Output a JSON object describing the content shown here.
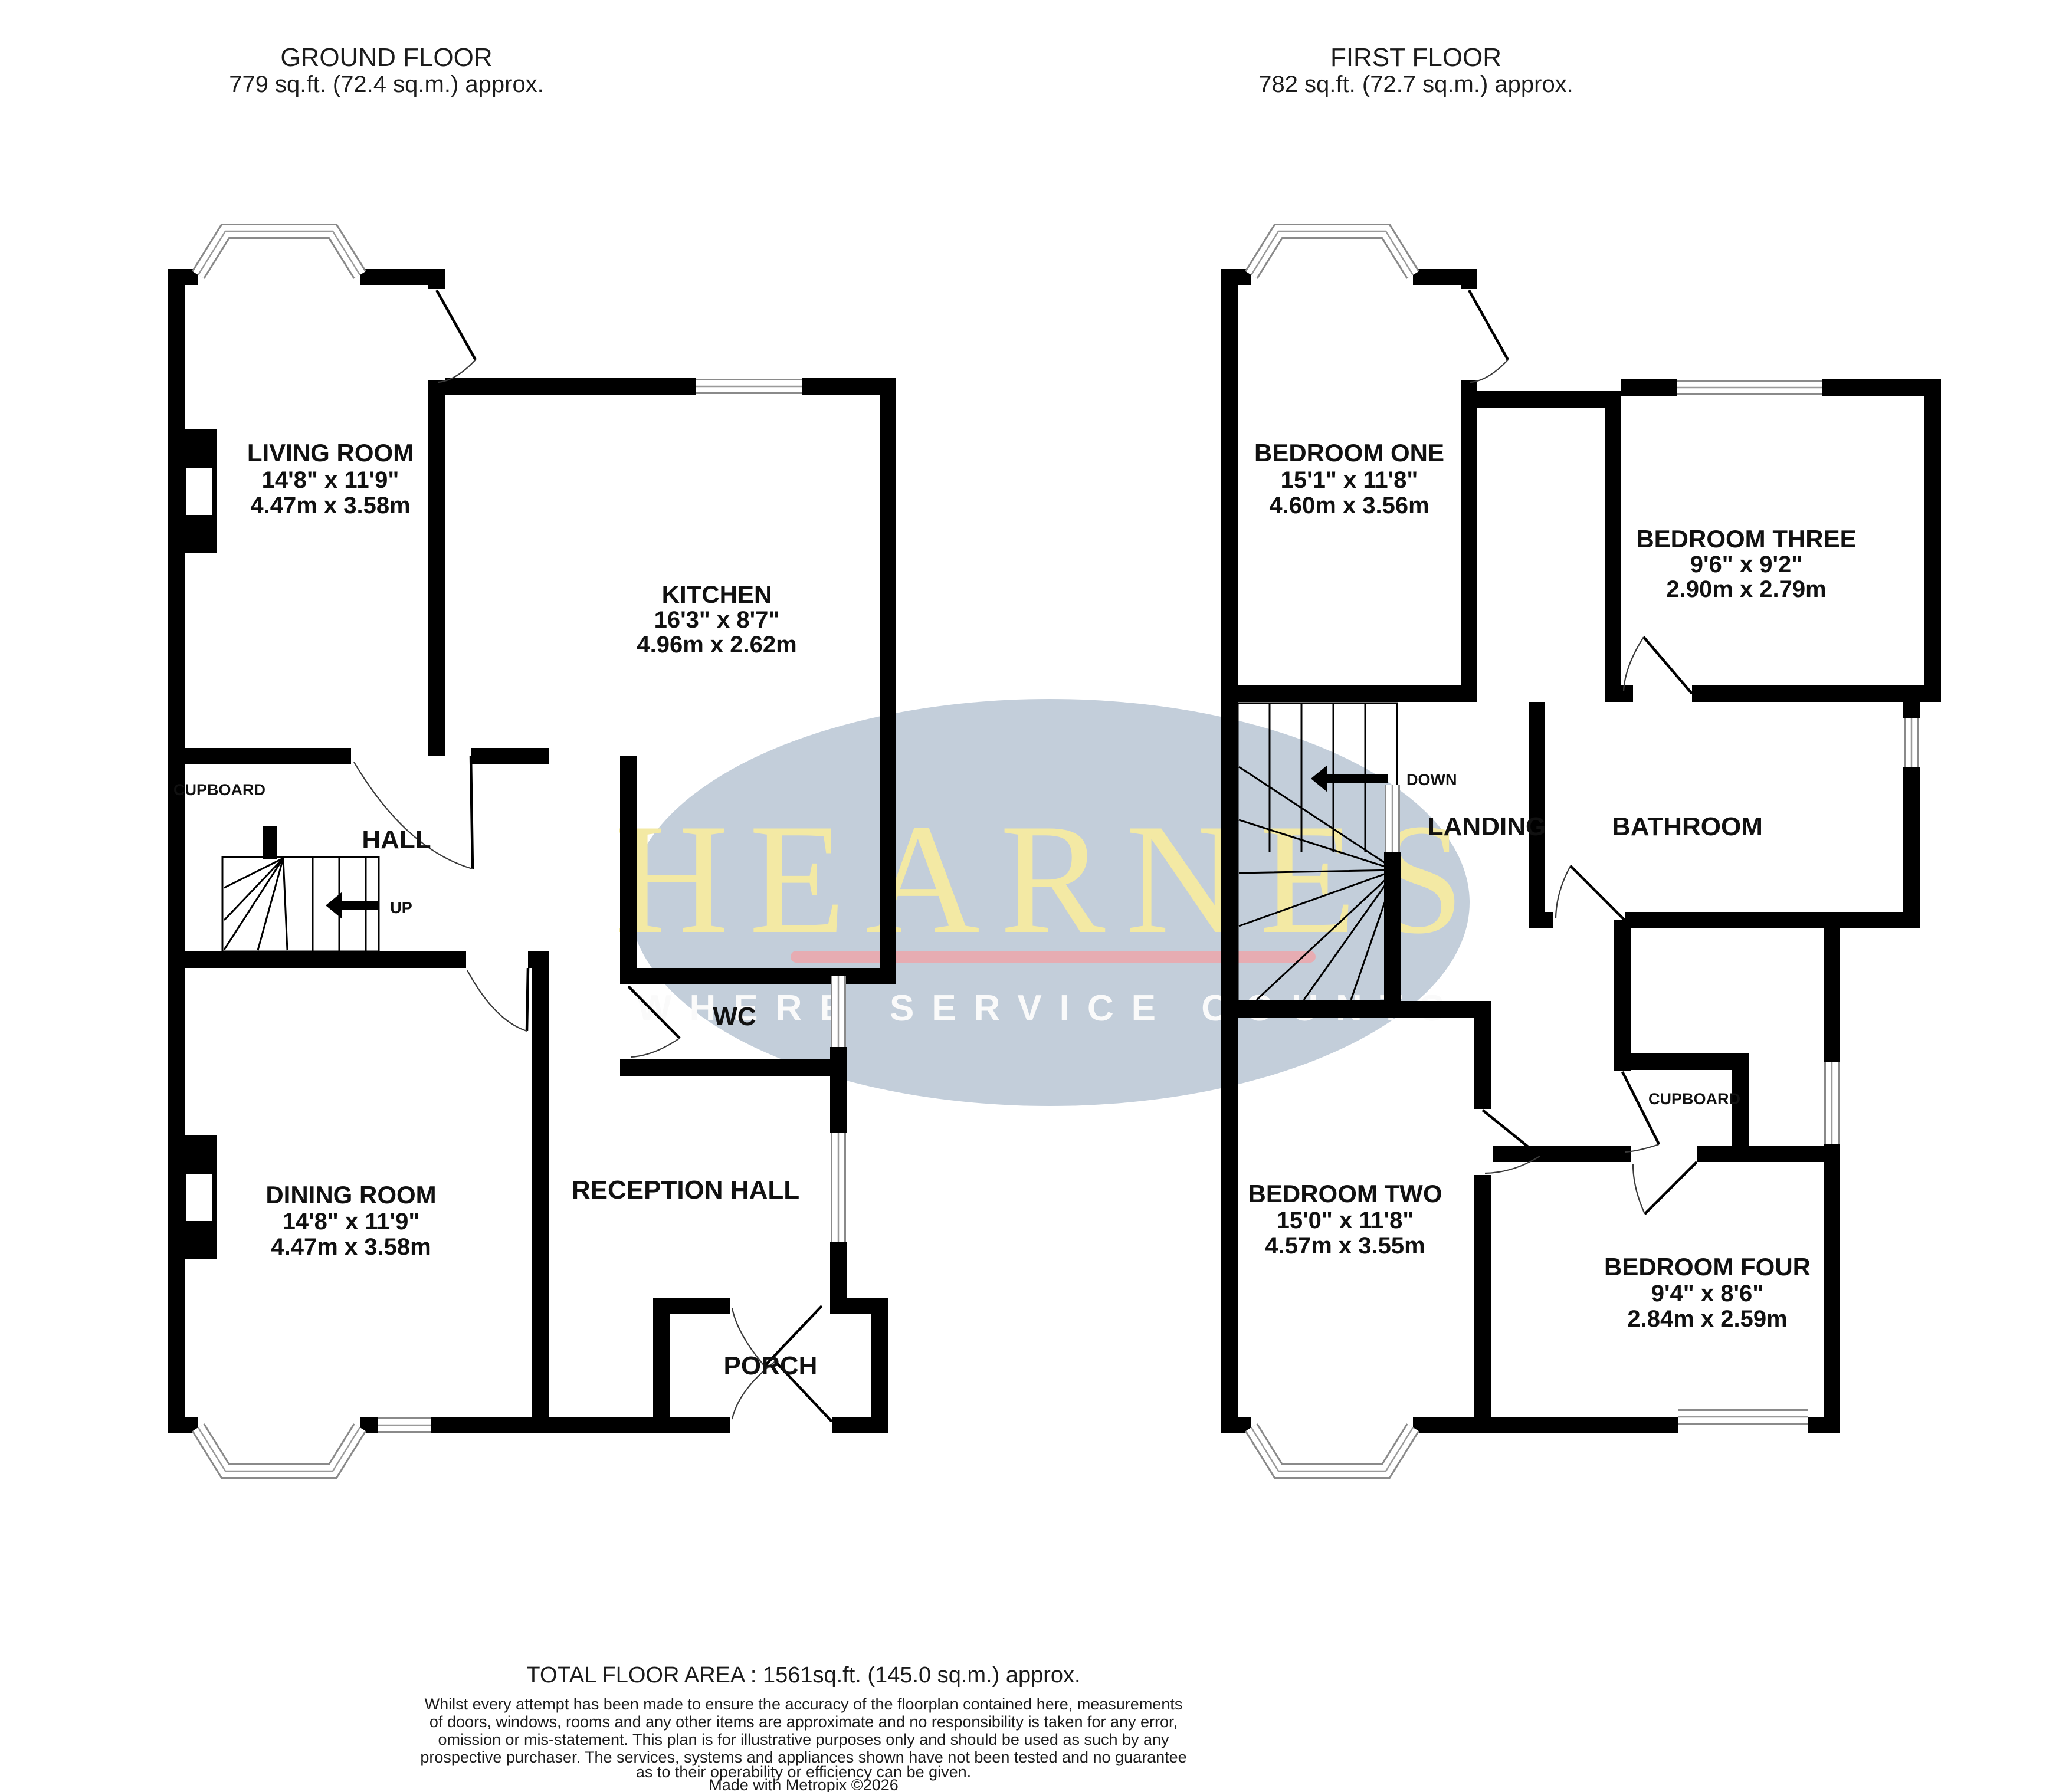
{
  "header": {
    "ground": {
      "title": "GROUND FLOOR",
      "area": "779 sq.ft. (72.4 sq.m.) approx."
    },
    "first": {
      "title": "FIRST FLOOR",
      "area": "782 sq.ft. (72.7 sq.m.) approx."
    }
  },
  "watermark": {
    "brand": "HEARNES",
    "tagline": "WHERE SERVICE COUNTS",
    "ellipse_color": "#b9c5d4",
    "brand_color": "#f3e9a4",
    "underline_color": "#eba9ad",
    "tagline_color": "#fafafa"
  },
  "ground_floor": {
    "rooms": {
      "living": {
        "name": "LIVING ROOM",
        "imperial": "14'8\" x 11'9\"",
        "metric": "4.47m x 3.58m"
      },
      "kitchen": {
        "name": "KITCHEN",
        "imperial": "16'3\" x 8'7\"",
        "metric": "4.96m x 2.62m"
      },
      "dining": {
        "name": "DINING ROOM",
        "imperial": "14'8\" x 11'9\"",
        "metric": "4.47m x 3.58m"
      },
      "hall": {
        "name": "HALL"
      },
      "cupboard": {
        "name": "CUPBOARD"
      },
      "wc": {
        "name": "WC"
      },
      "reception": {
        "name": "RECEPTION HALL"
      },
      "porch": {
        "name": "PORCH"
      }
    },
    "stairs_label": "UP"
  },
  "first_floor": {
    "rooms": {
      "bedroom_one": {
        "name": "BEDROOM ONE",
        "imperial": "15'1\" x 11'8\"",
        "metric": "4.60m x 3.56m"
      },
      "bedroom_two": {
        "name": "BEDROOM TWO",
        "imperial": "15'0\" x 11'8\"",
        "metric": "4.57m x 3.55m"
      },
      "bedroom_three": {
        "name": "BEDROOM THREE",
        "imperial": "9'6\" x 9'2\"",
        "metric": "2.90m x 2.79m"
      },
      "bedroom_four": {
        "name": "BEDROOM FOUR",
        "imperial": "9'4\" x 8'6\"",
        "metric": "2.84m x 2.59m"
      },
      "landing": {
        "name": "LANDING"
      },
      "bathroom": {
        "name": "BATHROOM"
      },
      "cupboard": {
        "name": "CUPBOARD"
      }
    },
    "stairs_label": "DOWN"
  },
  "footer": {
    "total": "TOTAL FLOOR AREA : 1561sq.ft. (145.0 sq.m.) approx.",
    "disclaimer_lines": [
      "Whilst every attempt has been made to ensure the accuracy of the floorplan contained here, measurements",
      "of doors, windows, rooms and any other items are approximate and no responsibility is taken for any error,",
      "omission or mis-statement. This plan is for illustrative purposes only and should be used as such by any",
      "prospective purchaser. The services, systems and appliances shown have not been tested and no guarantee",
      "as to their operability or efficiency can be given."
    ],
    "credit": "Made with Metropix ©2026"
  }
}
